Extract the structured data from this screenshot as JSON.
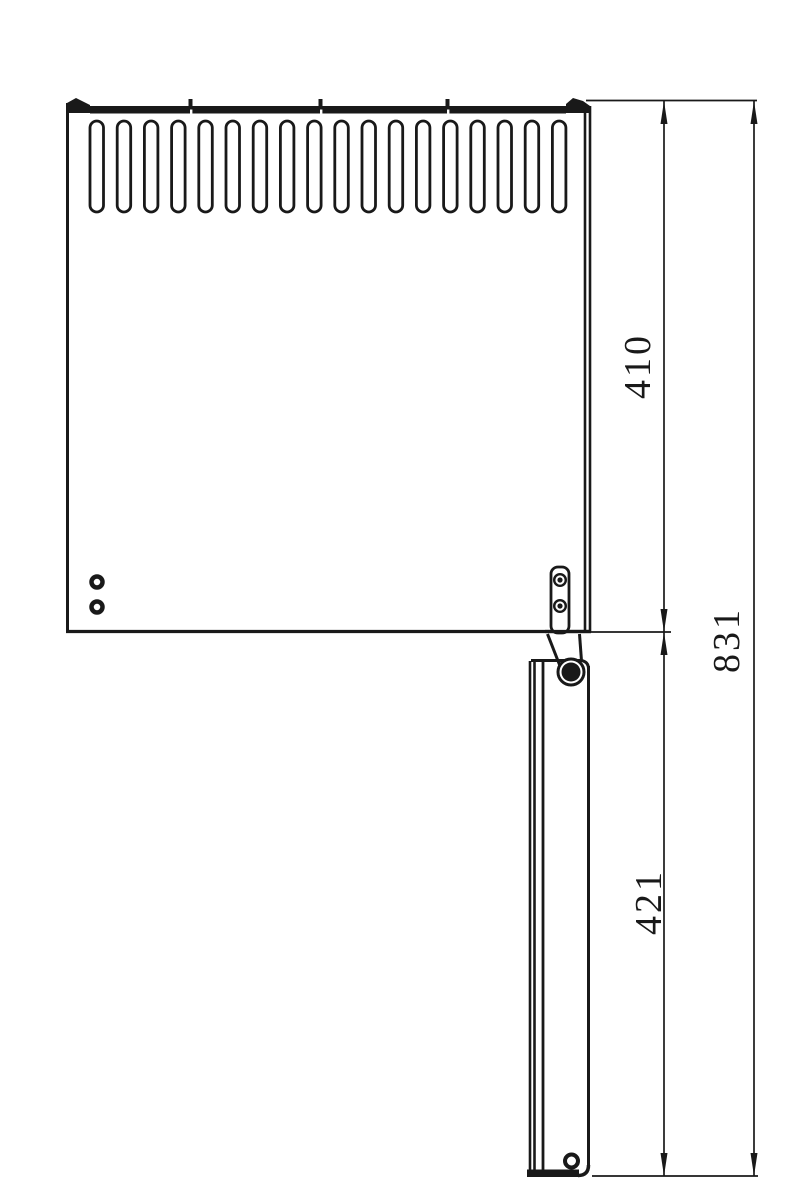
{
  "drawing": {
    "type": "technical-drawing-side-view",
    "background_color": "#ffffff",
    "line_color": "#191919",
    "vent_slot_count": 18,
    "labels": {
      "dim_panel": "410",
      "dim_flap": "421",
      "dim_overall": "831"
    }
  }
}
